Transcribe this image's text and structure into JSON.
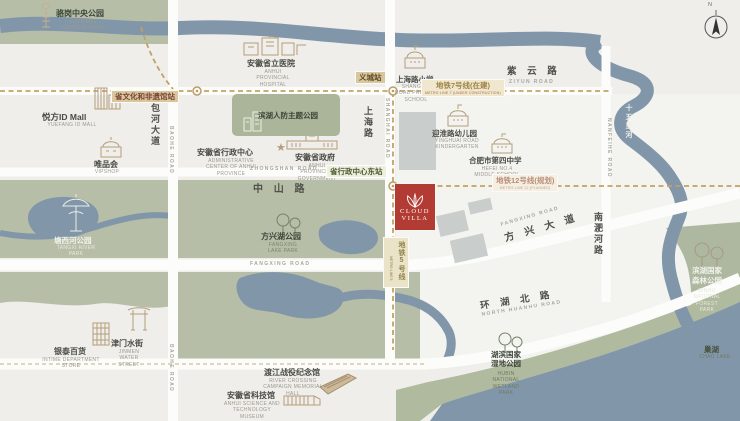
{
  "compass": {
    "label": "N"
  },
  "brand": {
    "line1": "CLOUD",
    "line2": "VILLA"
  },
  "colors": {
    "accent_red": "#b23c34",
    "park_green": "#b6bea8",
    "water_blue": "#8197a9",
    "road_white": "#fcfcfa",
    "metro_tan": "#c2a263",
    "land": "#efeeea"
  },
  "roads": {
    "ziyun": {
      "zh": "紫 云 路",
      "en": "ZIYUN ROAD"
    },
    "zhongshan": {
      "zh": "中 山 路",
      "en": "ZHONGSHAN ROAD"
    },
    "shanghai": {
      "zh": "上海路",
      "en": "SHANGHAI ROAD"
    },
    "baohe": {
      "zh": "包河大道",
      "en": "BAOHE ROAD"
    },
    "fangxing_w": {
      "en": "FANGXING ROAD"
    },
    "fangxing": {
      "zh": "方 兴 大 道",
      "en": "FANGXING ROAD"
    },
    "huanhu": {
      "zh": "环 湖 北 路",
      "en": "NORTH HUANHU ROAD"
    },
    "nanfeihe": {
      "zh": "南淝河路",
      "en": "NANFEIHE ROAD"
    },
    "shiwulihe": {
      "zh": "十五里河"
    }
  },
  "metro": {
    "line7_badge": {
      "zh": "地铁7号线(在建)",
      "en": "METRO LINE 7 (UNDER CONSTRUCTION)"
    },
    "line12_badge": {
      "zh": "地铁12号线(规划)",
      "en": "METRO LINE 12 (PLANNED)"
    },
    "line5_badge": {
      "zh": "地铁5号线",
      "en": "METRO LINE 5"
    },
    "stations": {
      "wenhua": "省文化和非遗馆站",
      "yicheng": "义城站",
      "xingzheng_east": "省行政中心东站"
    }
  },
  "pois": {
    "luogang": {
      "zh": "骆岗中央公园",
      "en": "LUOGANG CENTRAL PARK"
    },
    "hospital": {
      "zh": "安徽省立医院",
      "en": "ANHUI PROVINCIAL HOSPITAL"
    },
    "shanghai_primary": {
      "zh": "上海路小学",
      "en": "SHANGHAI ROAD PRIMARY SCHOOL"
    },
    "renfang": {
      "zh": "滨湖人防主题公园"
    },
    "yuefang": {
      "zh": "悦方ID Mall",
      "en": "YUEFANG ID MALL"
    },
    "vipshop": {
      "zh": "唯品会",
      "en": "VIPSHOP"
    },
    "admin_center": {
      "zh": "安徽省行政中心",
      "en": "ADMINISTRATIVE CENTER OF ANHUI PROVINCE"
    },
    "gov": {
      "zh": "安徽省政府",
      "en": "ANHUI PROVINCIAL GOVERNMENT"
    },
    "kindergarten": {
      "zh": "迎淮路幼儿园",
      "en": "YINGHUAI ROAD KINDERGARTEN"
    },
    "no4_school": {
      "zh": "合肥市第四中学",
      "en": "HEFEI NO.4 MIDDLE SCHOOL"
    },
    "tangxi": {
      "zh": "塘西河公园",
      "en": "TANGXI RIVER PARK"
    },
    "fangxinghu": {
      "zh": "方兴湖公园",
      "en": "FANGXING LAKE PARK"
    },
    "intime": {
      "zh": "银泰百货",
      "en": "INTIME DEPARTMENT STORE"
    },
    "jinmen": {
      "zh": "津门水街",
      "en": "JINMEN WATER STREET"
    },
    "dujiang": {
      "zh": "渡江战役纪念馆",
      "en": "RIVER CROSSING CAMPAIGN MEMORIAL HALL"
    },
    "tech_museum": {
      "zh": "安徽省科技馆",
      "en": "ANHUI SCIENCE AND TECHNOLOGY MUSEUM"
    },
    "forest": {
      "zh": "滨湖国家森林公园",
      "en": "BINHU NATIONAL FOREST PARK"
    },
    "wetland": {
      "zh": "湖滨国家湿地公园",
      "en": "HUBIN NATIONAL WETLAND PARK"
    },
    "chaohu": {
      "zh": "巢湖",
      "en": "CHAO LAKE"
    }
  }
}
